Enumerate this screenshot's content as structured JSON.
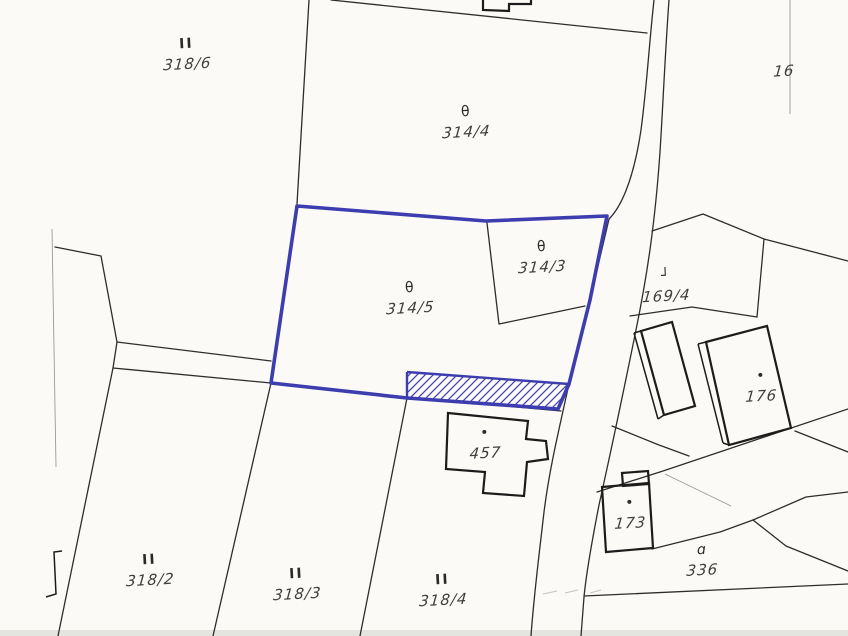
{
  "map": {
    "kind": "cadastral-parcel-map",
    "highlighted_parcel": "314/5",
    "colors": {
      "highlight": "#3d3daf",
      "ink": "#2d2d2d",
      "building": "#1c1c1c",
      "paper": "#fbfaf6",
      "faint": "#9a9a96"
    },
    "parcels": [
      {
        "label": "318/6",
        "symbol": "II"
      },
      {
        "label": "314/4",
        "symbol": "θ"
      },
      {
        "label": "314/3",
        "symbol": "θ"
      },
      {
        "label": "314/5",
        "symbol": "θ"
      },
      {
        "label": "169/4",
        "symbol": "┘"
      },
      {
        "label": "176",
        "symbol": "•"
      },
      {
        "label": "457",
        "symbol": "•"
      },
      {
        "label": "173",
        "symbol": "•"
      },
      {
        "label": "336",
        "symbol": "ɑ"
      },
      {
        "label": "318/2",
        "symbol": "II"
      },
      {
        "label": "318/3",
        "symbol": "II"
      },
      {
        "label": "318/4",
        "symbol": "II"
      },
      {
        "label": "16",
        "symbol": ""
      }
    ]
  }
}
